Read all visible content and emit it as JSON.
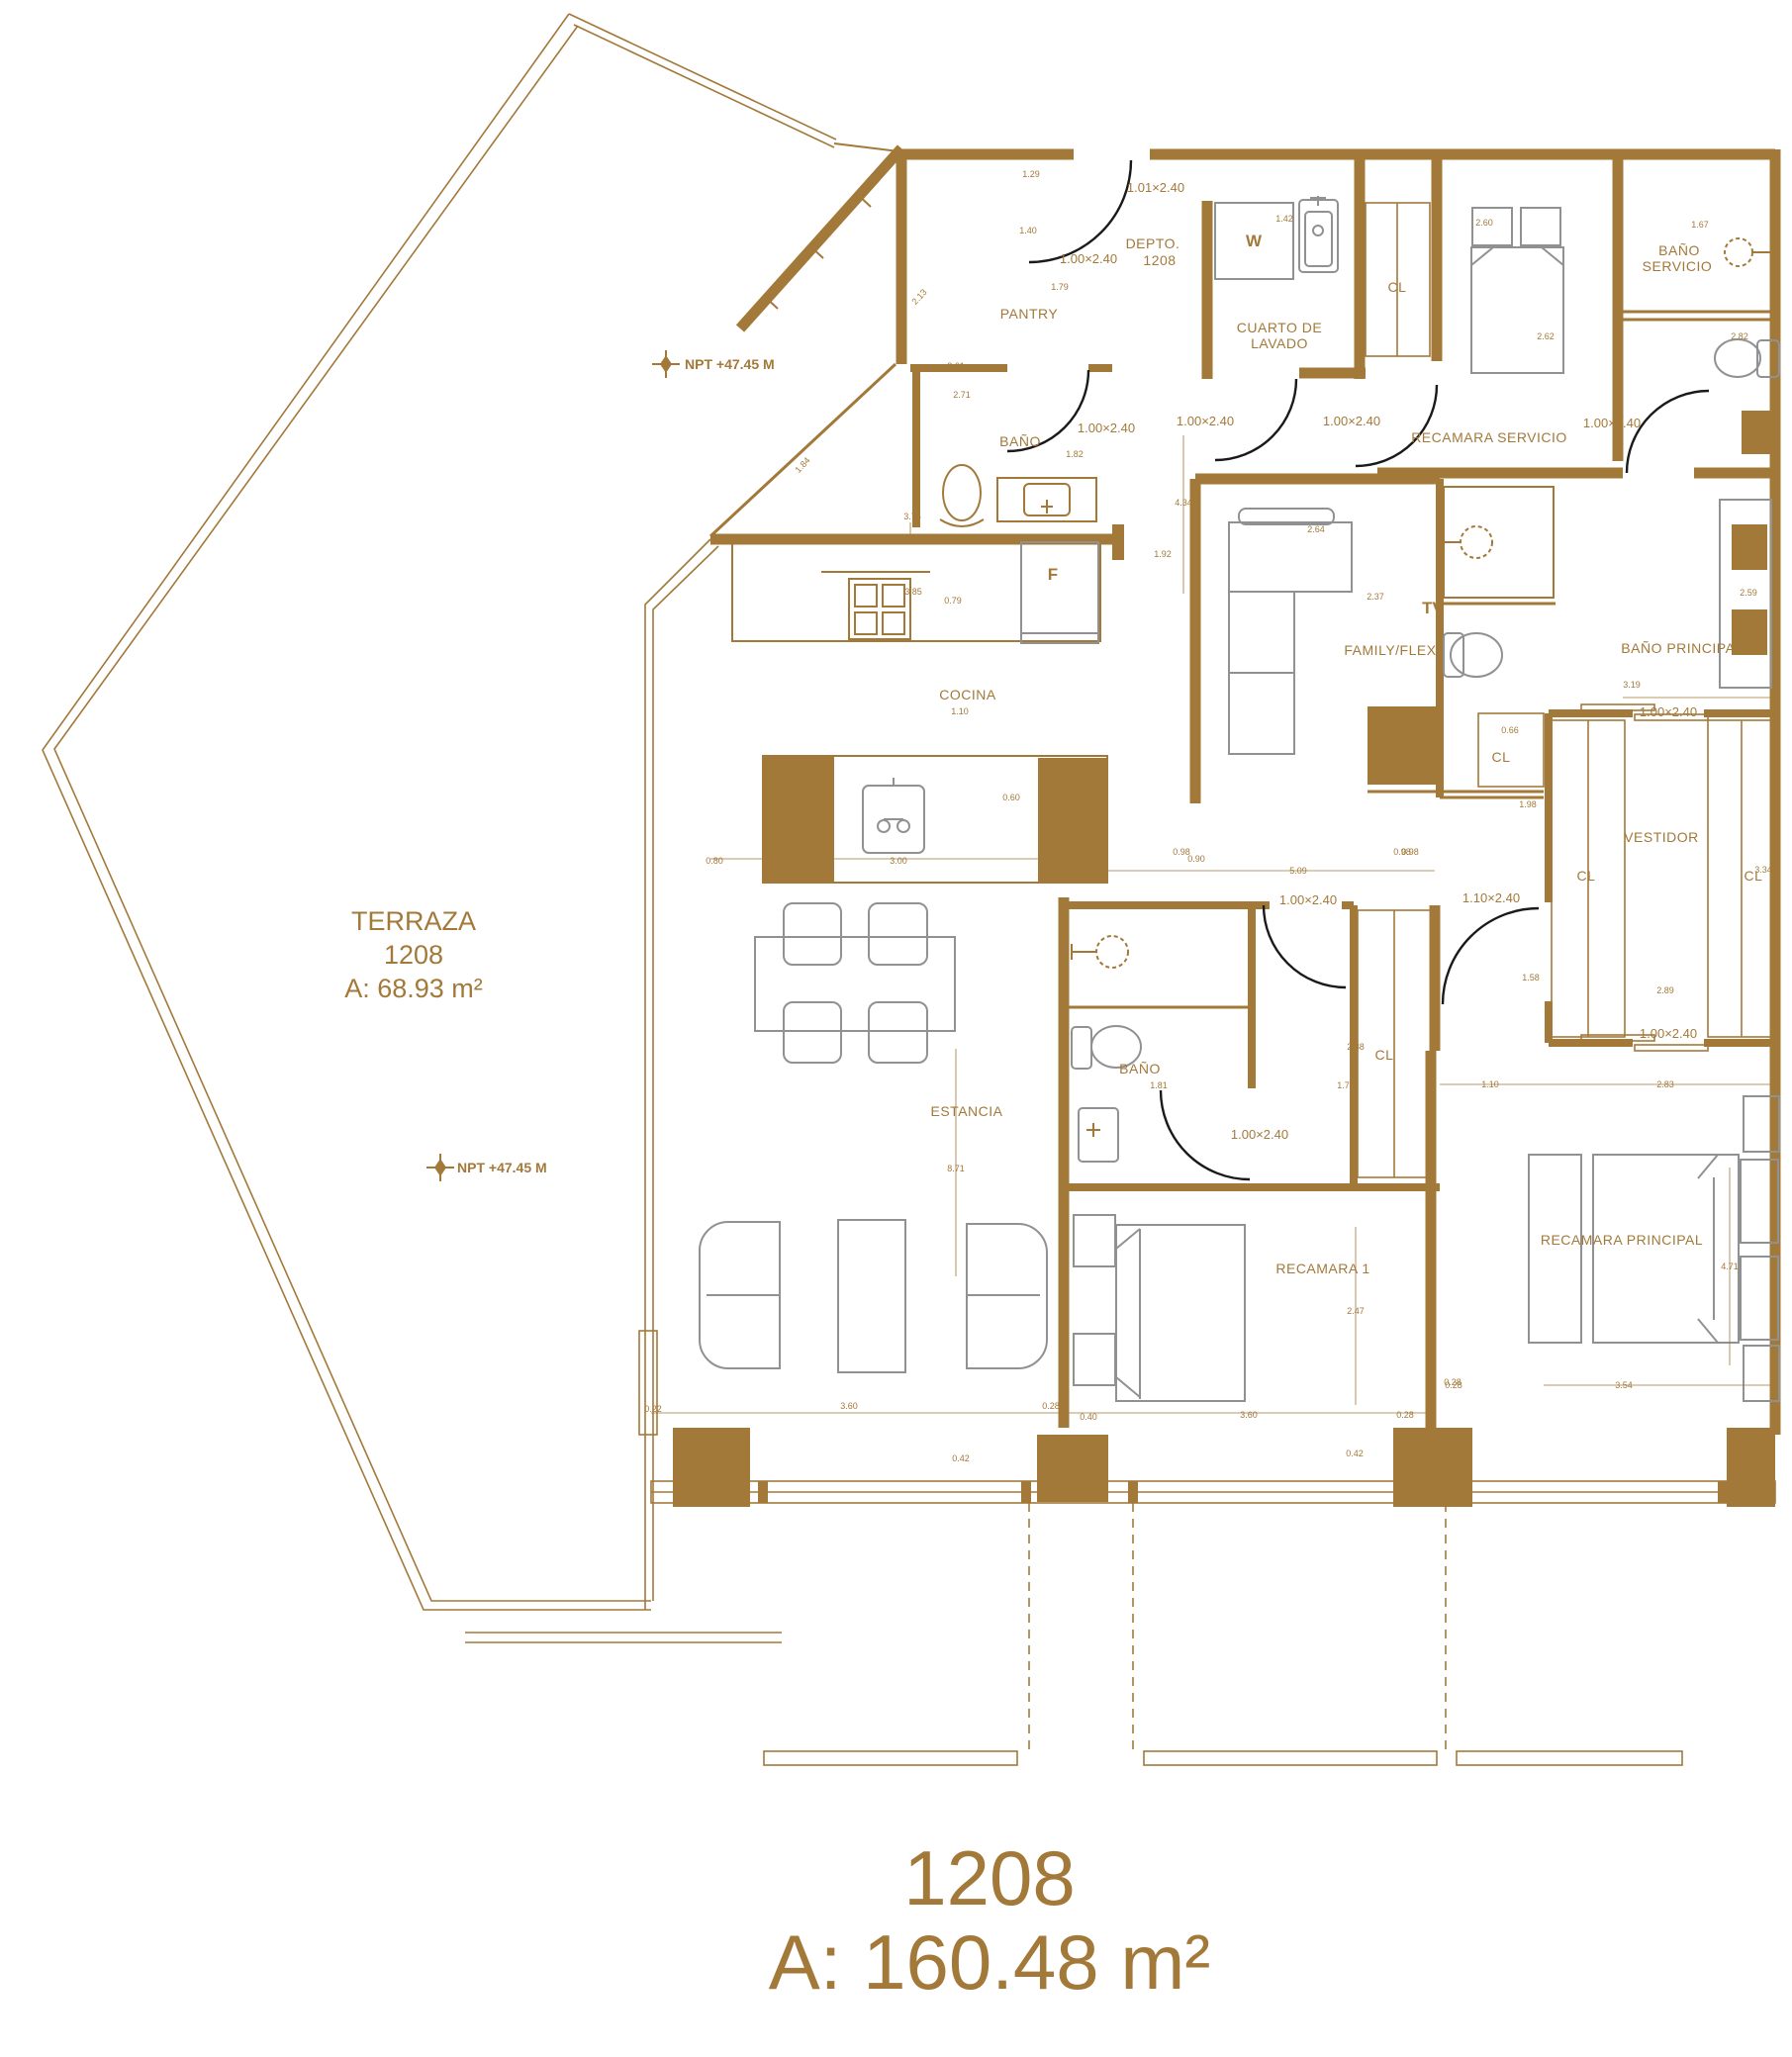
{
  "colors": {
    "line": "#A3793A",
    "furniture": "#8F9193",
    "door_arc": "#1A1A1A",
    "background": "#FFFFFF"
  },
  "title": {
    "unit": "1208",
    "area": "A: 160.48 m²"
  },
  "terrace": {
    "name": "TERRAZA",
    "unit": "1208",
    "area": "A: 68.93 m²"
  },
  "levels": {
    "npt1": "NPT +47.45 M",
    "npt2": "NPT +47.45 M"
  },
  "labels": {
    "pantry": "PANTRY",
    "depto": "DEPTO.",
    "depto_num": "1208",
    "w": "W",
    "lavado1": "CUARTO DE",
    "lavado2": "LAVADO",
    "cl_serv": "CL",
    "bano_serv1": "BAÑO",
    "bano_serv2": "SERVICIO",
    "rec_serv": "RECAMARA SERVICIO",
    "bano_guest": "BAÑO",
    "cocina": "COCINA",
    "fridge": "F",
    "tv": "TV",
    "family": "FAMILY/FLEX",
    "bano_principal": "BAÑO PRINCIPAL",
    "cl_family": "CL",
    "vestidor": "VESTIDOR",
    "cl_v1": "CL",
    "cl_v2": "CL",
    "estancia": "ESTANCIA",
    "bano_1": "BAÑO",
    "cl_1": "CL",
    "recamara1": "RECAMARA 1",
    "recamara_p": "RECAMARA PRINCIPAL"
  },
  "doors": {
    "dl1": "1.01×2.40",
    "dl2": "1.00×2.40",
    "dl3": "1.00×2.40",
    "dl4": "1.00×2.40",
    "dl5": "1.00×2.40",
    "dl6": "1.00×2.40",
    "dl7": "1.00×2.40",
    "dl8": "1.00×2.40",
    "dl9": "1.10×2.40",
    "dl10": "1.00×2.40",
    "dl11": "1.00×2.40"
  },
  "dims": {
    "d01": "1.29",
    "d03": "1.40",
    "d04": "1.42",
    "d05": "2.60",
    "d06": "1.67",
    "d07": "1.79",
    "d08": "2.13",
    "d09": "2.62",
    "d10": "2.82",
    "d11": "2.61",
    "d12": "2.71",
    "d13": "1.84",
    "d14": "1.82",
    "d15": "4.34",
    "d16": "3.75",
    "d17": "1.92",
    "d18": "3.85",
    "d19": "0.79",
    "d20": "2.64",
    "d21": "2.37",
    "d22": "3.19",
    "d23": "1.10",
    "d24": "0.66",
    "d25": "0.98",
    "d26": "1.98",
    "d27": "1.58",
    "d28": "3.34",
    "d29": "2.89",
    "d30": "0.60",
    "d31": "0.80",
    "d32": "3.00",
    "d33": "0.60",
    "d34": "0.90",
    "d35": "0.98",
    "d36": "5.09",
    "d37": "0.98",
    "d38": "2.88",
    "d39": "1.81",
    "d40": "1.75",
    "d41": "1.10",
    "d42": "2.83",
    "d43": "8.71",
    "d44": "2.47",
    "d45": "4.71",
    "d46": "2.59",
    "d47": "0.22",
    "d48": "3.60",
    "d49": "0.28",
    "d50": "0.40",
    "d51": "3.60",
    "d52": "0.28",
    "d53": "0.28",
    "d54": "0.42",
    "d55": "0.42",
    "d56": "3.54",
    "d57": "0.28"
  }
}
